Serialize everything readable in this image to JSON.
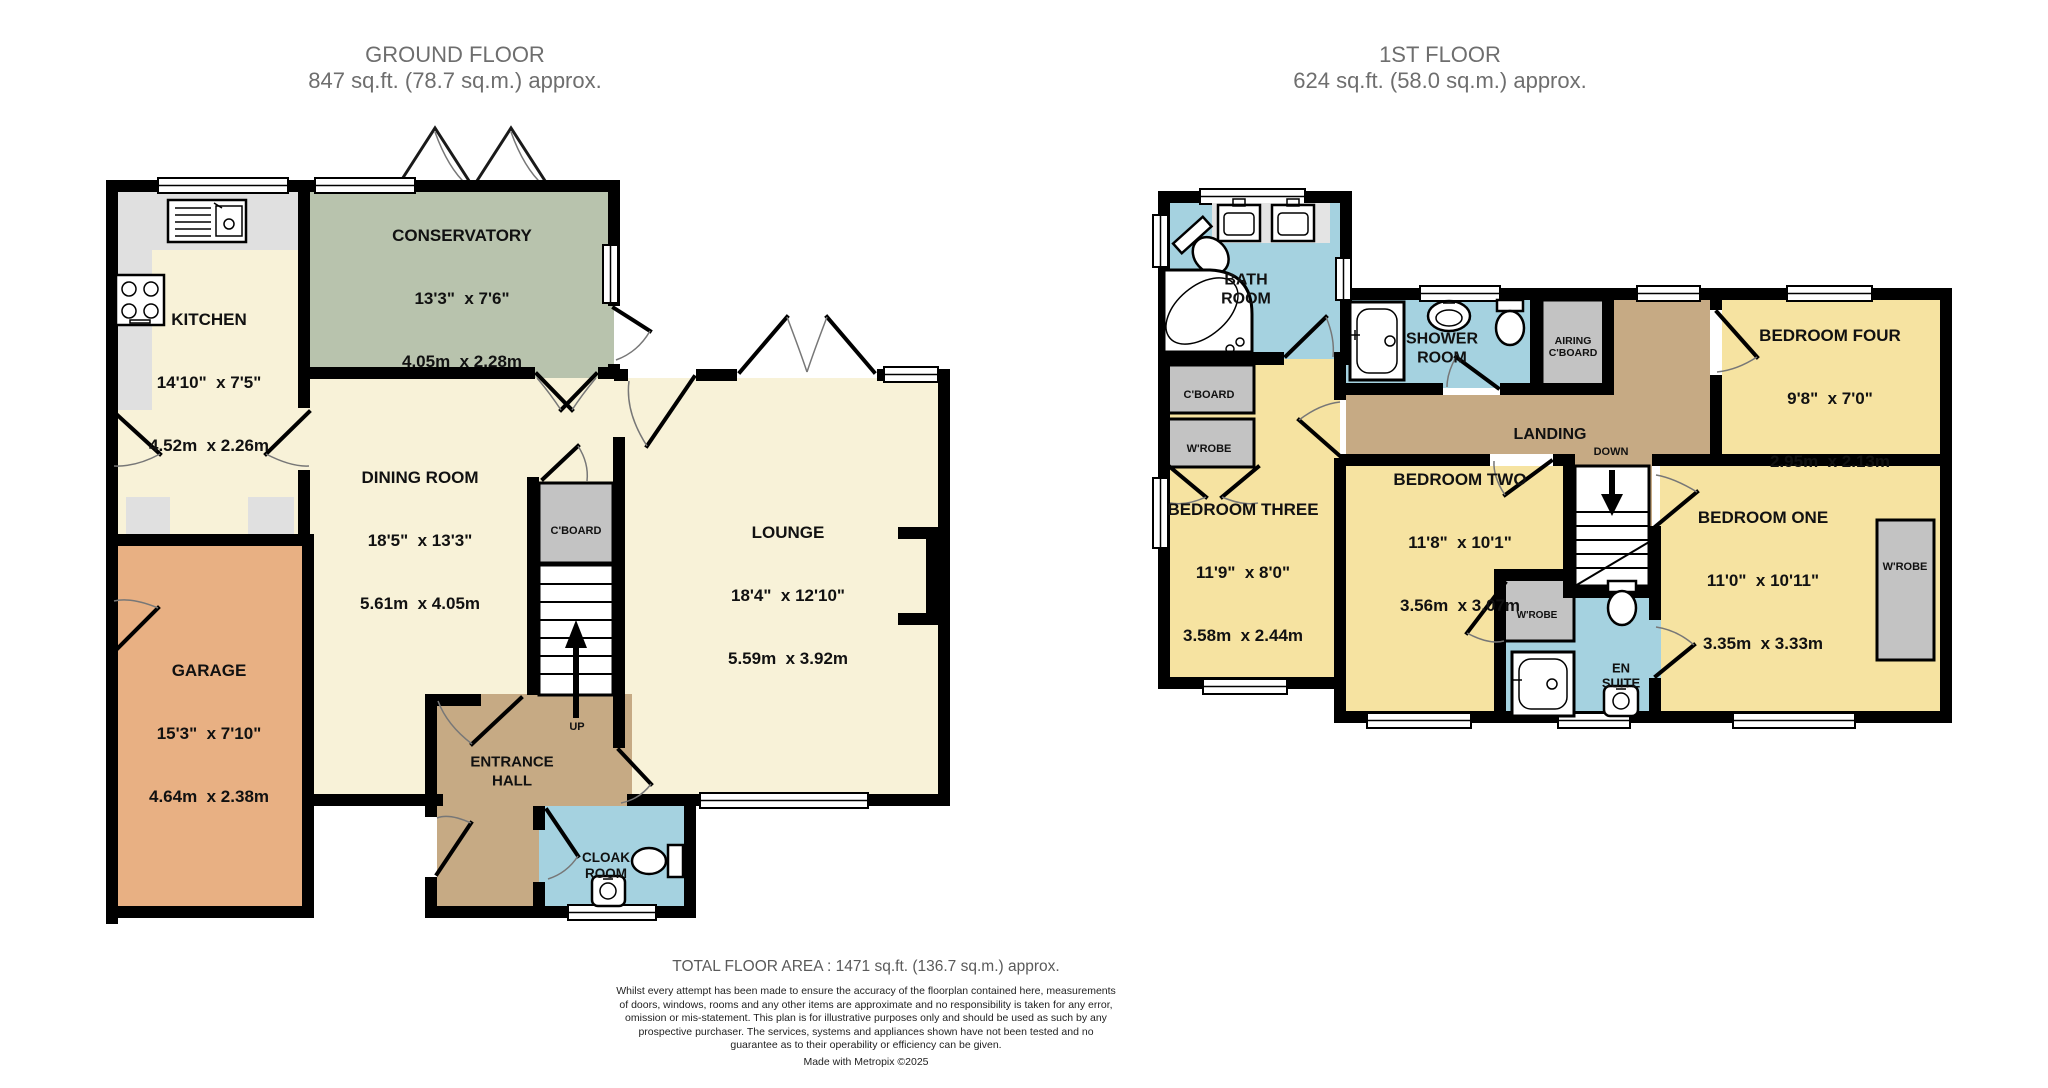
{
  "headers": {
    "ground": {
      "title": "GROUND FLOOR",
      "area": "847 sq.ft. (78.7 sq.m.) approx."
    },
    "first": {
      "title": "1ST FLOOR",
      "area": "624 sq.ft. (58.0 sq.m.) approx."
    }
  },
  "ground_floor": {
    "kitchen": {
      "name": "KITCHEN",
      "imperial": "14'10\"  x 7'5\"",
      "metric": "4.52m  x 2.26m"
    },
    "conservatory": {
      "name": "CONSERVATORY",
      "imperial": "13'3\"  x 7'6\"",
      "metric": "4.05m  x 2.28m"
    },
    "dining_room": {
      "name": "DINING ROOM",
      "imperial": "18'5\"  x 13'3\"",
      "metric": "5.61m  x 4.05m"
    },
    "lounge": {
      "name": "LOUNGE",
      "imperial": "18'4\"  x 12'10\"",
      "metric": "5.59m  x 3.92m"
    },
    "garage": {
      "name": "GARAGE",
      "imperial": "15'3\"  x 7'10\"",
      "metric": "4.64m  x 2.38m"
    },
    "entrance_hall": {
      "name": "ENTRANCE\nHALL"
    },
    "cloak_room": {
      "name": "CLOAK\nROOM"
    },
    "cupboard": {
      "name": "C'BOARD"
    },
    "stairs_label": "UP"
  },
  "first_floor": {
    "bath_room": {
      "name": "BATH\nROOM"
    },
    "shower_room": {
      "name": "SHOWER\nROOM"
    },
    "airing_cupboard": {
      "name": "AIRING\nC'BOARD"
    },
    "cupboard": {
      "name": "C'BOARD"
    },
    "wardrobe_bed3": {
      "name": "W'ROBE"
    },
    "wardrobe_bed2": {
      "name": "W'ROBE"
    },
    "wardrobe_bed1": {
      "name": "W'ROBE"
    },
    "landing": {
      "name": "LANDING"
    },
    "stairs_label": "DOWN",
    "bedroom_one": {
      "name": "BEDROOM ONE",
      "imperial": "11'0\"  x 10'11\"",
      "metric": "3.35m  x 3.33m"
    },
    "bedroom_two": {
      "name": "BEDROOM TWO",
      "imperial": "11'8\"  x 10'1\"",
      "metric": "3.56m  x 3.07m"
    },
    "bedroom_three": {
      "name": "BEDROOM THREE",
      "imperial": "11'9\"  x 8'0\"",
      "metric": "3.58m  x 2.44m"
    },
    "bedroom_four": {
      "name": "BEDROOM FOUR",
      "imperial": "9'8\"  x 7'0\"",
      "metric": "2.95m  x 2.13m"
    },
    "en_suite": {
      "name": "EN\nSUITE"
    }
  },
  "footer": {
    "total_area": "TOTAL FLOOR AREA : 1471 sq.ft. (136.7 sq.m.) approx.",
    "disclaimer": "Whilst every attempt has been made to ensure the accuracy of the floorplan contained here, measurements of doors, windows, rooms and any other items are approximate and no responsibility is taken for any error, omission or mis-statement. This plan is for illustrative purposes only and should be used as such by any prospective purchaser. The services, systems and appliances shown have not been tested and no guarantee as to their operability or efficiency can be given.",
    "credit": "Made with Metropix ©2025"
  },
  "colors": {
    "room_cream": "#f8f2d8",
    "bedroom_yellow": "#f6e3a1",
    "conservatory_green": "#b8c3ad",
    "garage_orange": "#e8b083",
    "hall_brown": "#c6aa84",
    "wet_room_blue": "#a5d2e0",
    "storage_grey": "#c3c3c3",
    "counter_grey": "#e0e0e0",
    "wall_black": "#000000",
    "title_grey": "#6e6e6e"
  }
}
